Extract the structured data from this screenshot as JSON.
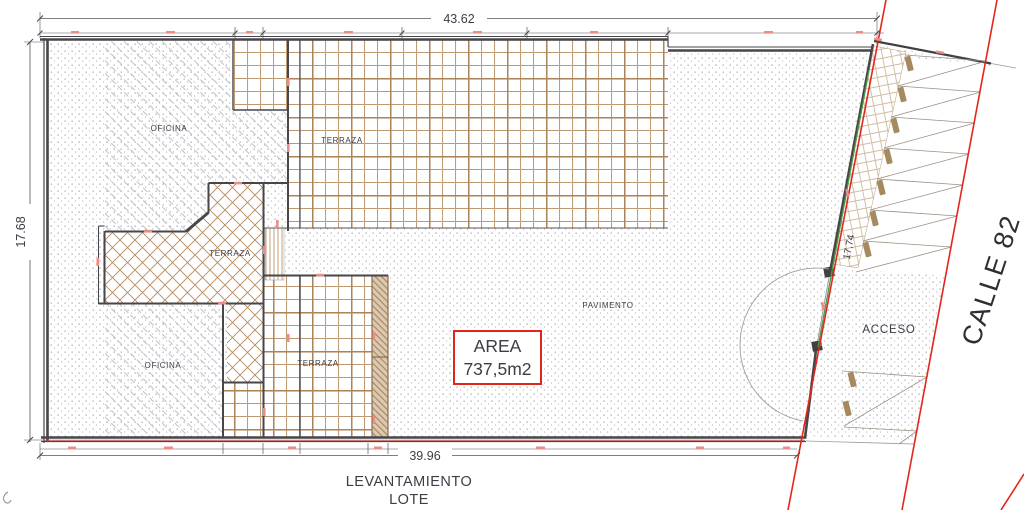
{
  "drawing": {
    "dimensions": {
      "top": "43.62",
      "left": "17.68",
      "bottom": "39.96",
      "right_slanted": "17,74"
    },
    "labels": {
      "oficina_top": "OFICINA",
      "terraza_top": "TERRAZA",
      "terraza_middle": "TERRAZA",
      "terraza_bottom": "TERRAZA",
      "oficina_bottom": "OFICINA",
      "pavimento": "PAVIMENTO",
      "acceso": "ACCESO"
    },
    "area_box": {
      "title": "AREA",
      "value": "737,5m2"
    },
    "street_name": "CALLE 82",
    "caption": {
      "line1": "LEVANTAMIENTO",
      "line2": "LOTE"
    },
    "colors": {
      "wall": "#46464b",
      "hatch_tan": "#b58a5d",
      "street_red": "#e3271c",
      "gate_green": "#43a047",
      "area_box_red": "#e0251b",
      "dim_text": "#3d3d46"
    }
  }
}
